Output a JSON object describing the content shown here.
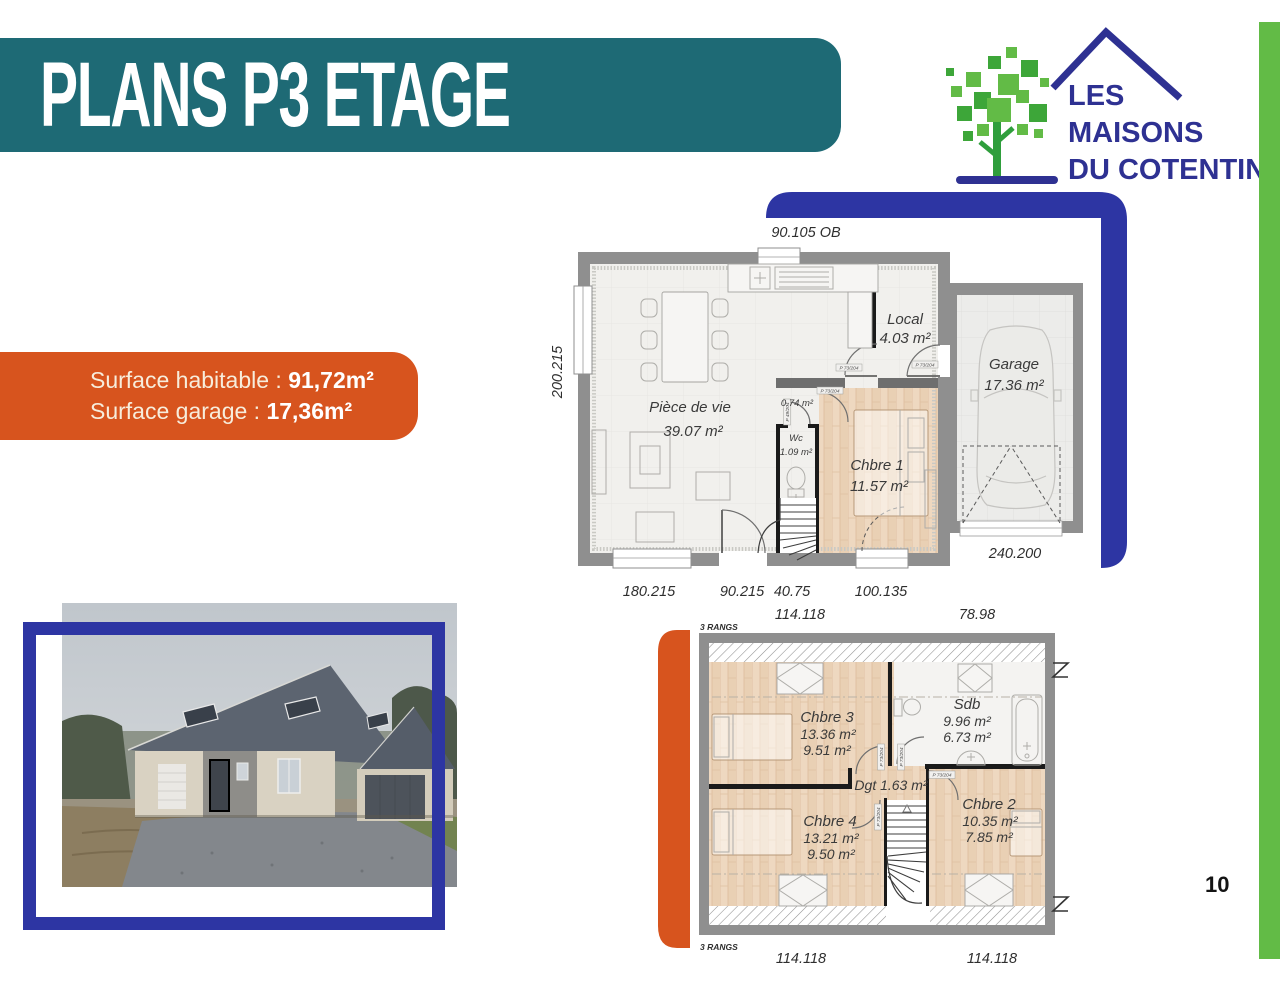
{
  "page": {
    "number": "10"
  },
  "header": {
    "title": "PLANS P3 ETAGE"
  },
  "logo": {
    "line1": "LES",
    "line2": "MAISONS",
    "line3": "DU COTENTIN"
  },
  "surface_banner": {
    "habitable_label": "Surface habitable : ",
    "habitable_value": "91,72m²",
    "garage_label": "Surface garage : ",
    "garage_value": "17,36m²"
  },
  "floor_ground": {
    "dim_top": "90.105 OB",
    "dim_left": "200.215",
    "dims_bottom_row1": [
      "180.215",
      "90.215",
      "40.75",
      "100.135"
    ],
    "dims_bottom_row2": [
      "114.118",
      "78.98"
    ],
    "dim_garage_bottom": "240.200",
    "rooms": {
      "piece_de_vie": {
        "name": "Pièce de vie",
        "area": "39.07 m²"
      },
      "local": {
        "name": "Local",
        "area": "4.03 m²"
      },
      "garage": {
        "name": "Garage",
        "area": "17.36 m²"
      },
      "vestibule": {
        "area": "0.74 m²"
      },
      "wc": {
        "name": "Wc",
        "area": "1.09 m²"
      },
      "chambre1": {
        "name": "Chbre 1",
        "area": "11.57 m²"
      }
    }
  },
  "floor_upper": {
    "rangs_label": "3 RANGS",
    "dims_bottom": [
      "114.118",
      "114.118"
    ],
    "rooms": {
      "chambre3": {
        "name": "Chbre 3",
        "area": "13.36 m²",
        "area2": "9.51 m²"
      },
      "sdb": {
        "name": "Sdb",
        "area": "9.96 m²",
        "area2": "6.73 m²"
      },
      "degagement": {
        "label": "Dgt 1.63 m²"
      },
      "chambre4": {
        "name": "Chbre 4",
        "area": "13.21 m²",
        "area2": "9.50 m²"
      },
      "chambre2": {
        "name": "Chbre 2",
        "area": "10.35 m²",
        "area2": "7.85 m²"
      }
    }
  },
  "door_tags": {
    "p73": "P 73/204",
    "p49": "P 49/204"
  },
  "colors": {
    "teal": "#1e6a75",
    "orange": "#d7541e",
    "blue": "#2d35a3",
    "green": "#62bb46",
    "navy": "#2e3192"
  }
}
